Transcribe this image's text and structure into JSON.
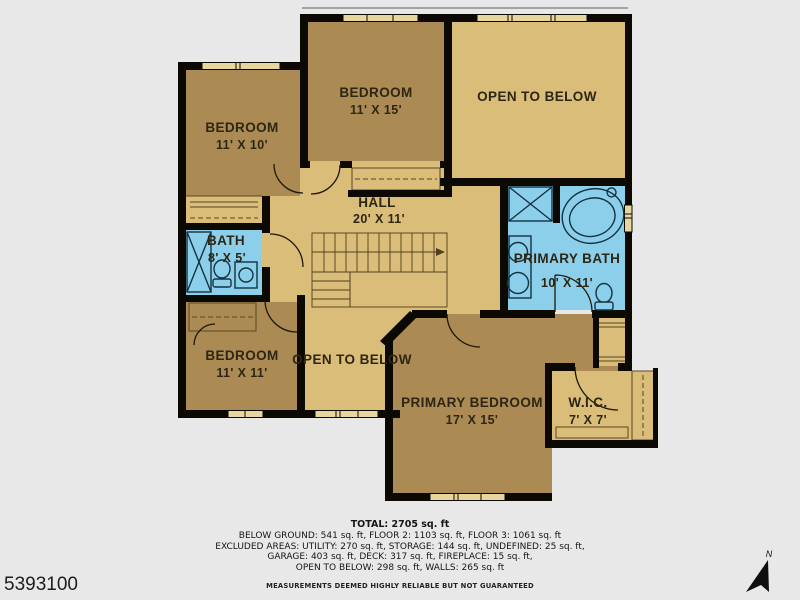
{
  "plan": {
    "rooms": {
      "bedroom_top_left": {
        "label": "BEDROOM",
        "dims": "11' X 10'"
      },
      "bedroom_top_center": {
        "label": "BEDROOM",
        "dims": "11' X 15'"
      },
      "bedroom_bottom_left": {
        "label": "BEDROOM",
        "dims": "11' X 11'"
      },
      "bath": {
        "label": "BATH",
        "dims": "8' X 5'"
      },
      "hall": {
        "label": "HALL",
        "dims": "20' X 11'"
      },
      "primary_bath": {
        "label": "PRIMARY BATH",
        "dims": "10' X 11'"
      },
      "primary_bedroom": {
        "label": "PRIMARY BEDROOM",
        "dims": "17' X 15'"
      },
      "wic": {
        "label": "W.I.C.",
        "dims": "7' X 7'"
      },
      "open_to_below_top": {
        "label": "OPEN TO BELOW"
      },
      "open_to_below_bottom": {
        "label": "OPEN TO BELOW"
      }
    },
    "compass": {
      "label": "N"
    }
  },
  "summary": {
    "total": "TOTAL: 2705 sq. ft",
    "lines": [
      "BELOW GROUND: 541 sq. ft, FLOOR 2: 1103 sq. ft, FLOOR 3: 1061 sq. ft",
      "EXCLUDED AREAS: UTILITY: 270 sq. ft, STORAGE: 144 sq. ft, UNDEFINED: 25 sq. ft,",
      "GARAGE: 403 sq. ft, DECK: 317 sq. ft, FIREPLACE: 15 sq. ft,",
      "OPEN TO BELOW: 298 sq. ft, WALLS: 265 sq. ft"
    ],
    "disclaimer": "MEASUREMENTS DEEMED HIGHLY RELIABLE BUT NOT GUARANTEED"
  },
  "listing_id": "5393100",
  "colors": {
    "background": "#e8e8e8",
    "wall": "#0c0903",
    "room_dark_tan": "#ab8a53",
    "room_light_tan": "#d9bd78",
    "room_blue": "#8ccfeb",
    "window_fill": "#e7d79e",
    "label_text": "#2e2614"
  }
}
